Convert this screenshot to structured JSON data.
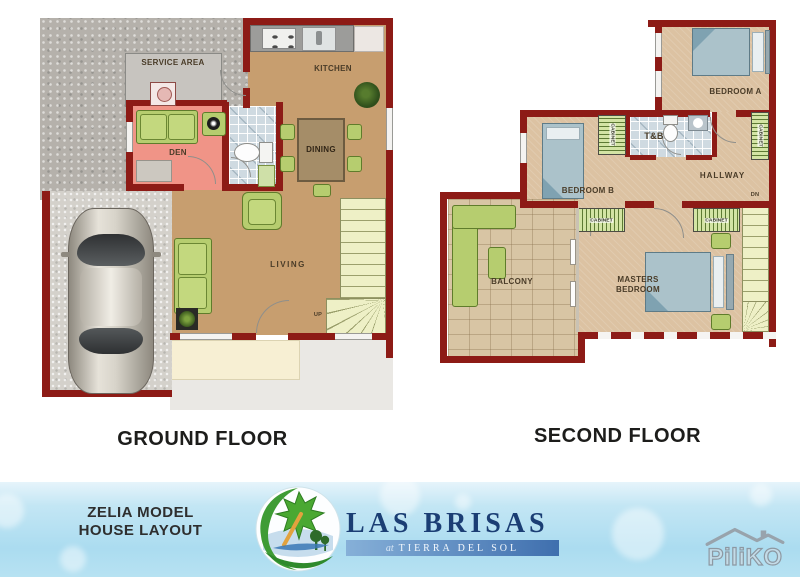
{
  "ground_floor": {
    "title": "GROUND FLOOR",
    "labels": {
      "service_area": "SERVICE AREA",
      "kitchen": "KITCHEN",
      "dining": "DINING",
      "den": "DEN",
      "living": "LIVING",
      "stairs_up": "UP"
    }
  },
  "second_floor": {
    "title": "SECOND FLOOR",
    "labels": {
      "bedroom_a": "BEDROOM A",
      "toilet_bath": "T&B",
      "bedroom_b": "BEDROOM B",
      "hallway": "HALLWAY",
      "cabinet": "CABINET",
      "balcony": "BALCONY",
      "masters_bedroom": "MASTERS BEDROOM",
      "stairs_down": "DN"
    }
  },
  "footer": {
    "model_line1": "ZELIA MODEL",
    "model_line2": "HOUSE LAYOUT",
    "brand_name": "LAS BRISAS",
    "brand_tagline_prefix": "at",
    "brand_tagline": "TIERRA DEL SOL",
    "watermark": "PiliKO"
  },
  "icons": {
    "logo": "las-brisas-leaf-globe-logo",
    "watermark_icon": "roof-icon"
  },
  "colors": {
    "wall_red": "#8d1b16",
    "floor_tan_ground": "#c79e6f",
    "floor_tan_second": "#dcc2a2",
    "den_pink": "#f09487",
    "tile_blue": "#cfdae1",
    "furniture_green": "#b6cd6f",
    "stairs_cream": "#eef0c6",
    "banner_blue": "#b7e2f2",
    "brand_navy": "#1b3e74",
    "tagline_bar_blue": "#3f6fae"
  }
}
